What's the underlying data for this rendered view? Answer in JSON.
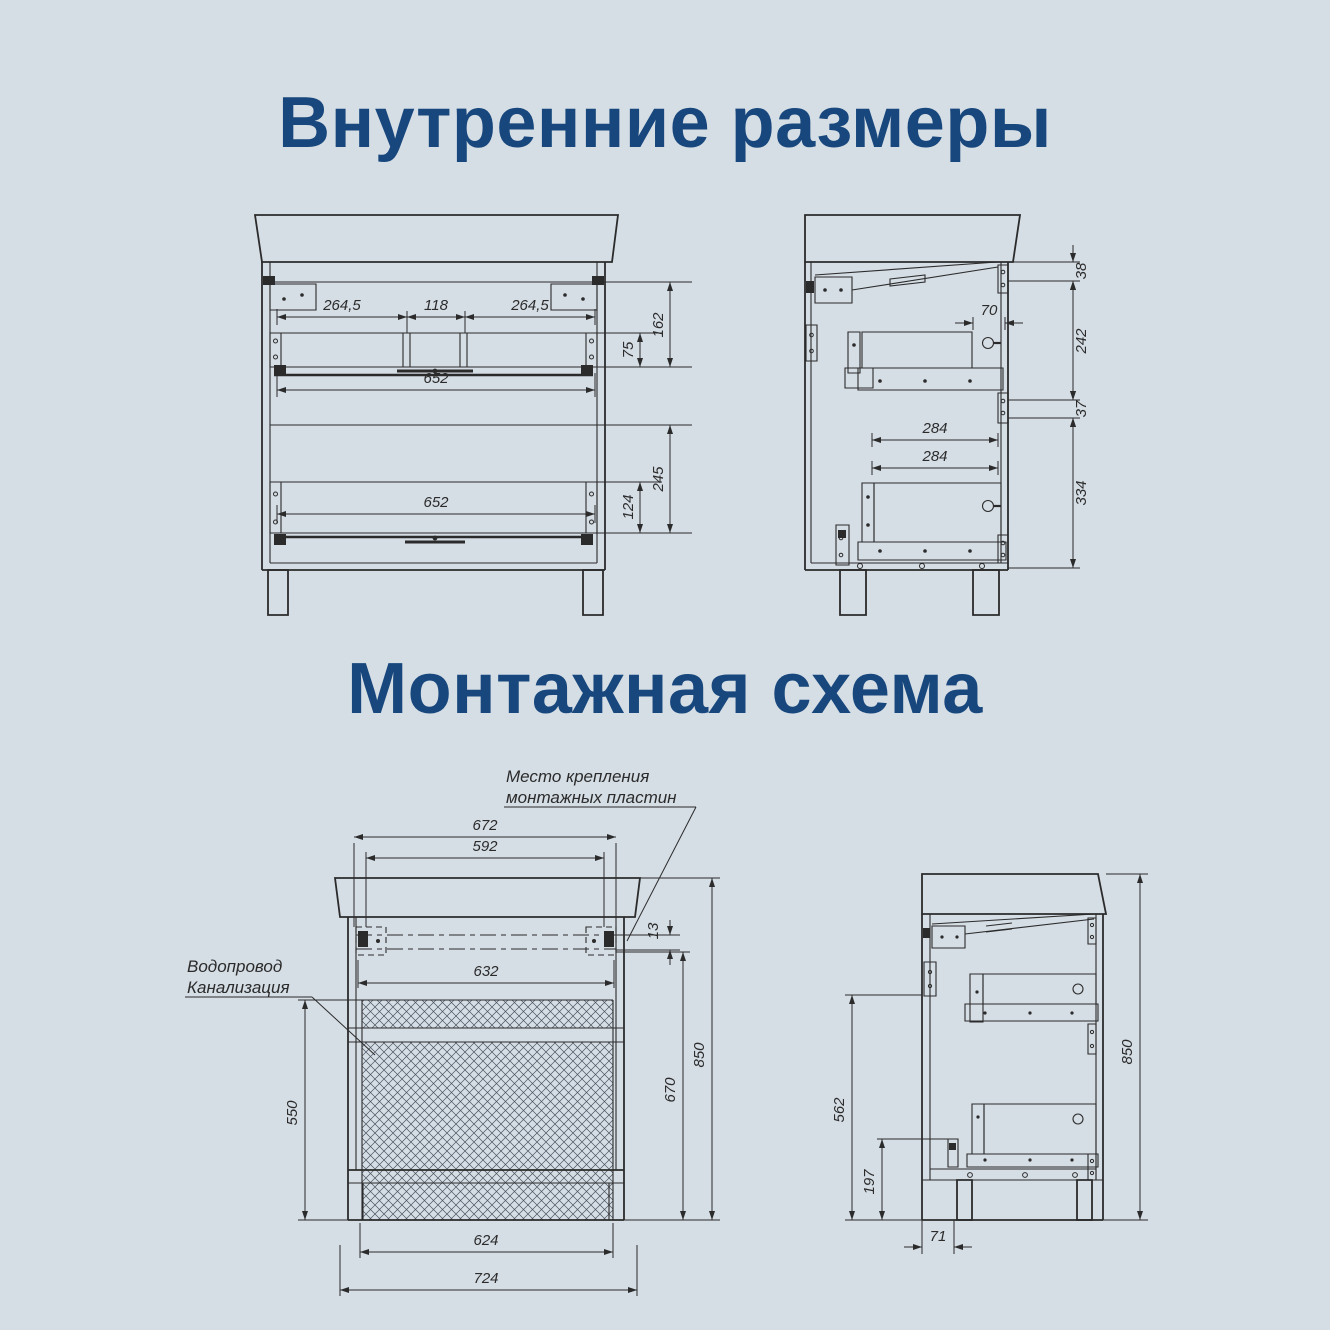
{
  "page": {
    "background": "#d5dde5",
    "accent": "#17477c",
    "line_color": "#2b2b2b"
  },
  "titles": {
    "internal": "Внутренние размеры",
    "mounting": "Монтажная схема"
  },
  "internal": {
    "front": {
      "left_offset": "264,5",
      "center_gap": "118",
      "right_offset": "264,5",
      "top_width": "652",
      "top_section_height": "162",
      "top_drawer_height": "75",
      "bottom_width": "652",
      "bottom_section_height": "245",
      "bottom_drawer_height": "124"
    },
    "side": {
      "top_gap": "38",
      "rail_offset": "70",
      "top_section_depth": "242",
      "mid_gap": "37",
      "top_drawer_depth": "284",
      "bottom_drawer_depth": "284",
      "bottom_section_depth": "334"
    }
  },
  "mounting": {
    "plate_note_line1": "Место крепления",
    "plate_note_line2": "монтажных пластин",
    "plumbing_note_line1": "Водопровод",
    "plumbing_note_line2": "Канализация",
    "front": {
      "plate_outer_span": "672",
      "plate_inner_span": "592",
      "rail_span": "632",
      "plate_drop": "13",
      "overall_height": "850",
      "rail_height": "670",
      "service_zone_height": "550",
      "base_width": "624",
      "overall_width": "724"
    },
    "side": {
      "overall_height": "850",
      "service_zone_height": "562",
      "base_zone_height": "197",
      "back_offset": "71"
    }
  }
}
